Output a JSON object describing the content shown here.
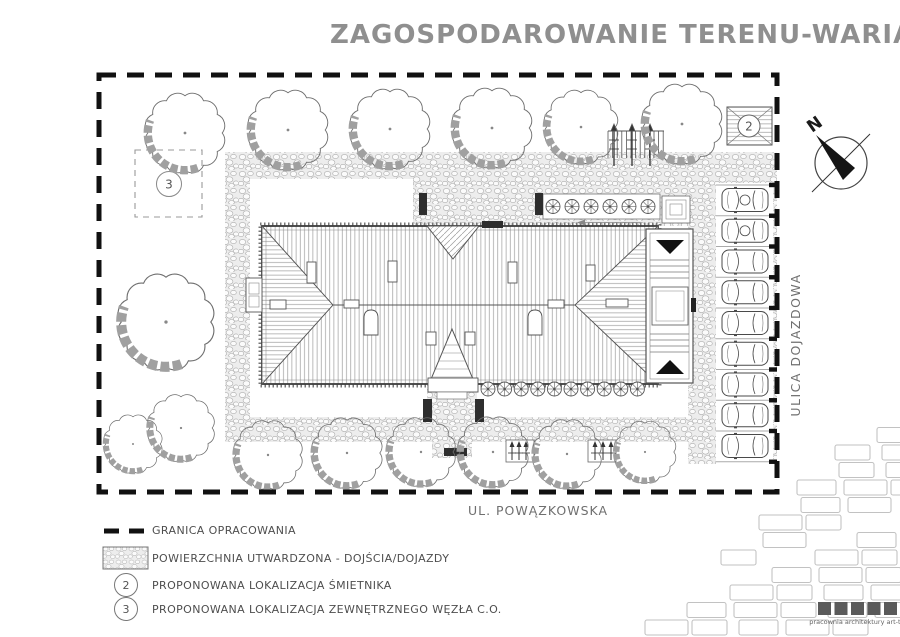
{
  "title": "ZAGOSPODAROWANIE TERENU-WARIANT 4",
  "plan": {
    "north_label": "N",
    "street_right_label": "ULICA DOJAZDOWA",
    "street_bottom_label": "UL. POWĄZKOWSKA",
    "marker_trash": "2",
    "marker_heating": "3"
  },
  "legend": {
    "items": [
      {
        "symbol": "dashed-boundary-line",
        "label": "GRANICA OPRACOWANIA"
      },
      {
        "symbol": "hatched-paving-swatch",
        "label": "POWIERZCHNIA UTWARDZONA - DOJŚCIA/DOJAZDY"
      },
      {
        "symbol": "2",
        "label": "PROPONOWANA LOKALIZACJA ŚMIETNIKA"
      },
      {
        "symbol": "3",
        "label": "PROPONOWANA LOKALIZACJA ZEWNĘTRZNEGO WĘZŁA C.O."
      }
    ]
  },
  "footer": {
    "studio_label": "pracownia architektury art-tu"
  },
  "colors": {
    "ink": "#3a3a3a",
    "title_gray": "#8f8f8f",
    "text_gray": "#6f6f6f",
    "tree_shadow": "#a0a0a0",
    "boundary_black": "#111111"
  }
}
